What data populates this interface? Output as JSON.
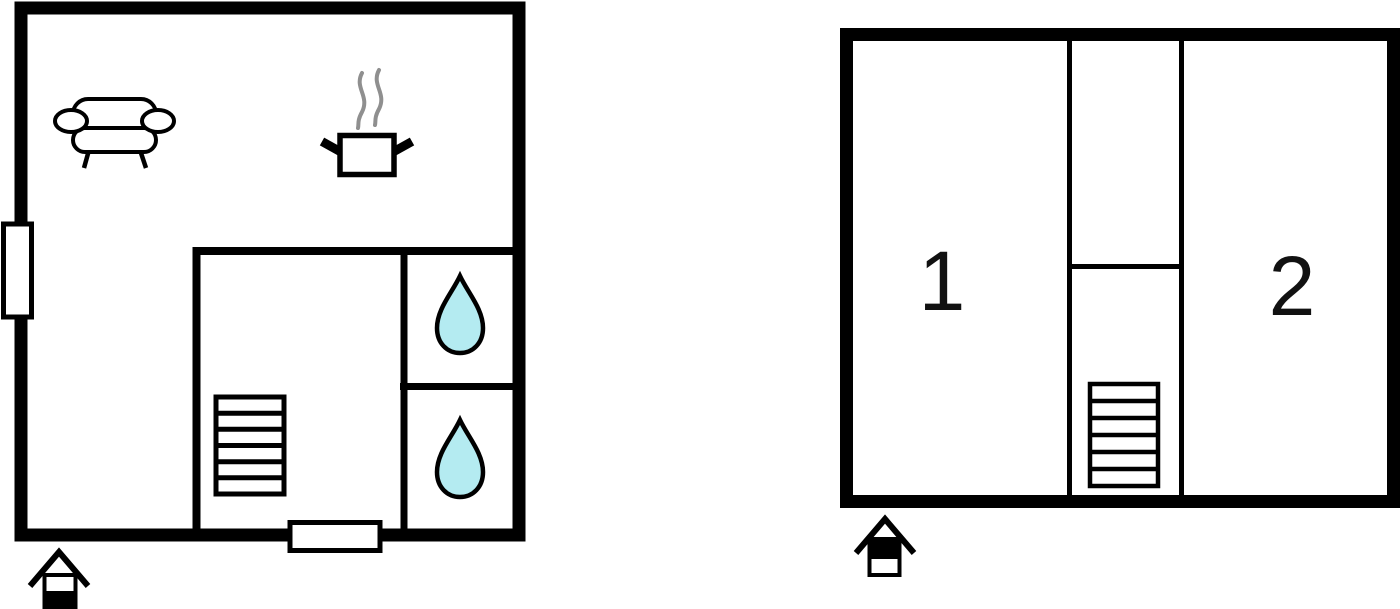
{
  "canvas": {
    "width": 1400,
    "height": 609,
    "background": "#ffffff"
  },
  "colors": {
    "wall": "#000000",
    "fixture_fill": "#ffffff",
    "water_drop": "#b4ebf1",
    "steam": "#8f8f8f",
    "label_text": "#111111"
  },
  "ground_floor": {
    "name": "ground-floor-plan",
    "stairs_treads": 6,
    "features": [
      "sofa",
      "cooking-pot",
      "steam",
      "window",
      "door",
      "stairs",
      "shower-room-top",
      "shower-room-bottom"
    ]
  },
  "upper_floor": {
    "name": "upper-floor-plan",
    "room1_label": "1",
    "room2_label": "2",
    "stairs_treads": 6
  },
  "icons": {
    "sofa": "sofa-icon",
    "cooking_pot": "cooking-pot-icon",
    "steam": "steam-icon",
    "water_drop": "water-drop-icon",
    "stairs": "stairs-icon",
    "window": "window-marker",
    "door": "door-marker",
    "house_marker": "house-orientation-icon"
  }
}
